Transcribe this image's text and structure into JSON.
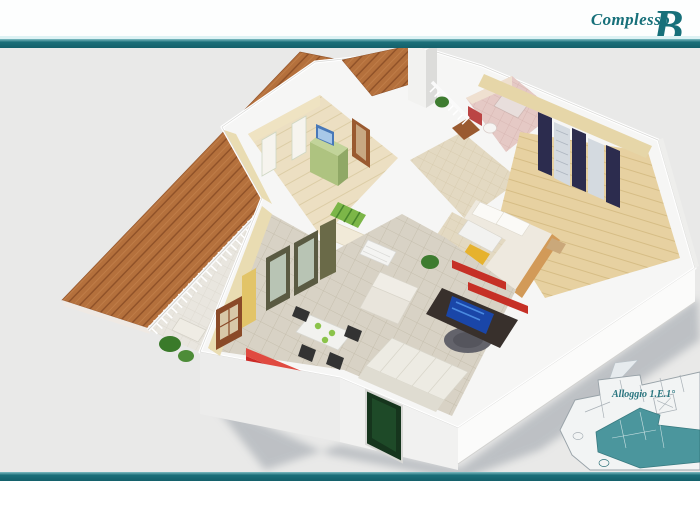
{
  "header": {
    "complex_label": "Complesso",
    "complex_initial": "B"
  },
  "plan_annotation": {
    "label": "Alloggio 1.E.1°"
  },
  "colors": {
    "accent_teal": "#1b6f79",
    "header_text_teal": "#17707a",
    "canvas_background": "#e9e9e8",
    "page_background": "#fdfdfd",
    "highlighted_unit_teal": "#3d8f96",
    "deck_wood": "#b4703c",
    "exterior_wall_white": "#f6f6f5",
    "interior_wall_cream": "#e9dcb2",
    "living_tile": "#d8d2c5",
    "bedroom_wood": "#ecdfc2",
    "bathroom_pink": "#e5c9c5",
    "kitchen_counter_red": "#cc2a26",
    "entry_door_green": "#16351d",
    "shadow_gray": "#9aa0a8"
  }
}
